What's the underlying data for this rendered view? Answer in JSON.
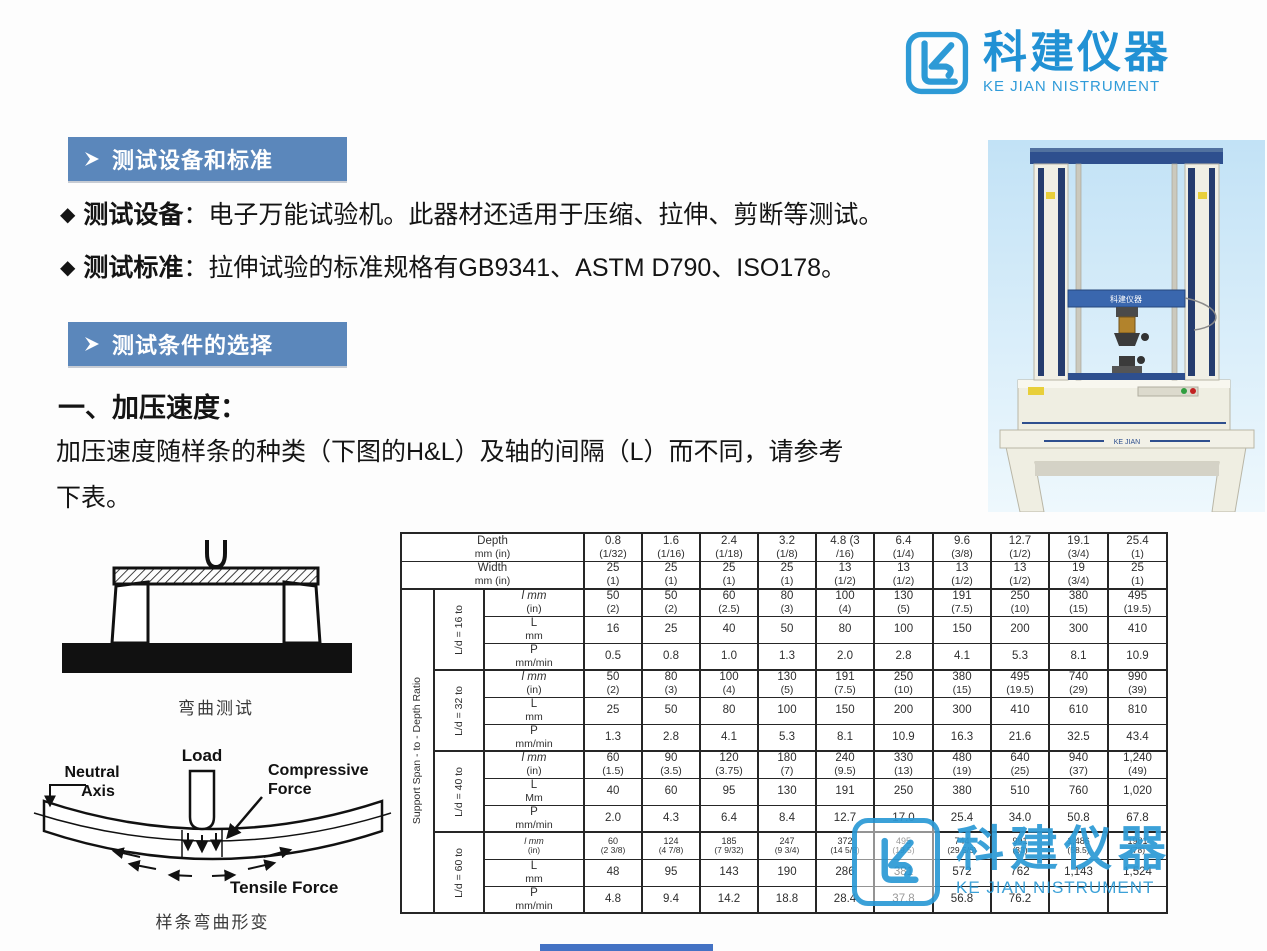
{
  "colors": {
    "banner_blue": "#5b87bb",
    "brand_blue": "#2191d4",
    "navy": "#2e4f8e"
  },
  "logo": {
    "title": "科建仪器",
    "subtitle": "KE JIAN NISTRUMENT"
  },
  "sections": {
    "banner_equipment": "测试设备和标准",
    "banner_conditions": "测试条件的选择",
    "bullet_equipment_label": "测试设备",
    "bullet_equipment_text": "：电子万能试验机。此器材还适用于压缩、拉伸、剪断等测试。",
    "bullet_standard_label": "测试标准",
    "bullet_standard_text": "：拉伸试验的标准规格有GB9341、ASTM D790、ISO178。",
    "heading_speed": "一、加压速度：",
    "para_line1": "加压速度随样条的种类（下图的H&L）及轴的间隔（L）而不同，请参考",
    "para_line2": "下表。"
  },
  "machine": {
    "stand_text": "KE JIAN",
    "crosshead_text": "科建仪器"
  },
  "diagrams": {
    "bend_caption": "弯曲测试",
    "deform_caption": "样条弯曲形变",
    "labels": {
      "load": "Load",
      "compressive1": "Compressive",
      "compressive2": "Force",
      "neutral1": "Neutral",
      "neutral2": "Axis",
      "tensile": "Tensile  Force"
    }
  },
  "table": {
    "outer_label": "Support Span - to - Depth Ratio",
    "header_rows": [
      {
        "label": "Depth",
        "unit": "mm  (in)",
        "cells": [
          [
            "0.8",
            "(1/32)"
          ],
          [
            "1.6",
            "(1/16)"
          ],
          [
            "2.4",
            "(1/18)"
          ],
          [
            "3.2",
            "(1/8)"
          ],
          [
            "4.8  (3",
            "/16)"
          ],
          [
            "6.4",
            "(1/4)"
          ],
          [
            "9.6",
            "(3/8)"
          ],
          [
            "12.7",
            "(1/2)"
          ],
          [
            "19.1",
            "(3/4)"
          ],
          [
            "25.4",
            "(1)"
          ]
        ]
      },
      {
        "label": "Width",
        "unit": "mm  (in)",
        "cells": [
          [
            "25",
            "(1)"
          ],
          [
            "25",
            "(1)"
          ],
          [
            "25",
            "(1)"
          ],
          [
            "25",
            "(1)"
          ],
          [
            "13",
            "(1/2)"
          ],
          [
            "13",
            "(1/2)"
          ],
          [
            "13",
            "(1/2)"
          ],
          [
            "13",
            "(1/2)"
          ],
          [
            "19",
            "(3/4)"
          ],
          [
            "25",
            "(1)"
          ]
        ]
      }
    ],
    "groups": [
      {
        "label": "L/d = 16 to",
        "rows": [
          {
            "main": "l  mm",
            "unit": "(in)",
            "italic": true,
            "cells": [
              [
                "50",
                "(2)"
              ],
              [
                "50",
                "(2)"
              ],
              [
                "60",
                "(2.5)"
              ],
              [
                "80",
                "(3)"
              ],
              [
                "100",
                "(4)"
              ],
              [
                "130",
                "(5)"
              ],
              [
                "191",
                "(7.5)"
              ],
              [
                "250",
                "(10)"
              ],
              [
                "380",
                "(15)"
              ],
              [
                "495",
                "(19.5)"
              ]
            ]
          },
          {
            "main": "L",
            "unit": "mm",
            "cells": [
              "16",
              "25",
              "40",
              "50",
              "80",
              "100",
              "150",
              "200",
              "300",
              "410"
            ]
          },
          {
            "main": "P",
            "unit": "mm/min",
            "cells": [
              "0.5",
              "0.8",
              "1.0",
              "1.3",
              "2.0",
              "2.8",
              "4.1",
              "5.3",
              "8.1",
              "10.9"
            ]
          }
        ]
      },
      {
        "label": "L/d = 32 to",
        "rows": [
          {
            "main": "l  mm",
            "unit": "(in)",
            "italic": true,
            "cells": [
              [
                "50",
                "(2)"
              ],
              [
                "80",
                "(3)"
              ],
              [
                "100",
                "(4)"
              ],
              [
                "130",
                "(5)"
              ],
              [
                "191",
                "(7.5)"
              ],
              [
                "250",
                "(10)"
              ],
              [
                "380",
                "(15)"
              ],
              [
                "495",
                "(19.5)"
              ],
              [
                "740",
                "(29)"
              ],
              [
                "990",
                "(39)"
              ]
            ]
          },
          {
            "main": "L",
            "unit": "mm",
            "cells": [
              "25",
              "50",
              "80",
              "100",
              "150",
              "200",
              "300",
              "410",
              "610",
              "810"
            ]
          },
          {
            "main": "P",
            "unit": "mm/min",
            "cells": [
              "1.3",
              "2.8",
              "4.1",
              "5.3",
              "8.1",
              "10.9",
              "16.3",
              "21.6",
              "32.5",
              "43.4"
            ]
          }
        ]
      },
      {
        "label": "L/d = 40 to",
        "rows": [
          {
            "main": "l  mm",
            "unit": "(in)",
            "italic": true,
            "cells": [
              [
                "60",
                "(1.5)"
              ],
              [
                "90",
                "(3.5)"
              ],
              [
                "120",
                "(3.75)"
              ],
              [
                "180",
                "(7)"
              ],
              [
                "240",
                "(9.5)"
              ],
              [
                "330",
                "(13)"
              ],
              [
                "480",
                "(19)"
              ],
              [
                "640",
                "(25)"
              ],
              [
                "940",
                "(37)"
              ],
              [
                "1,240",
                "(49)"
              ]
            ]
          },
          {
            "main": "L",
            "unit": "Mm",
            "cells": [
              "40",
              "60",
              "95",
              "130",
              "191",
              "250",
              "380",
              "510",
              "760",
              "1,020"
            ]
          },
          {
            "main": "P",
            "unit": "mm/min",
            "cells": [
              "2.0",
              "4.3",
              "6.4",
              "8.4",
              "12.7",
              "17.0",
              "25.4",
              "34.0",
              "50.8",
              "67.8"
            ]
          }
        ]
      },
      {
        "label": "L/d = 60 to",
        "rows": [
          {
            "main": "l  mm",
            "unit": "(in)",
            "italic": true,
            "small": true,
            "cells": [
              [
                "60",
                "(2  3/8)"
              ],
              [
                "124",
                "(4  7/8)"
              ],
              [
                "185",
                "(7  9/32)"
              ],
              [
                "247",
                "(9  3/4)"
              ],
              [
                "372",
                "(14  5/8)"
              ],
              [
                "495",
                "(19.5)"
              ],
              [
                "744",
                "(29  5/6)"
              ],
              [
                "991",
                "(33)"
              ],
              [
                "1,486",
                "(58.5)"
              ],
              [
                "1981",
                "(78)"
              ]
            ]
          },
          {
            "main": "L",
            "unit": "mm",
            "cells": [
              "48",
              "95",
              "143",
              "190",
              "286",
              "381",
              "572",
              "762",
              "1,143",
              "1,524"
            ]
          },
          {
            "main": "P",
            "unit": "mm/min",
            "cells": [
              "4.8",
              "9.4",
              "14.2",
              "18.8",
              "28.4",
              "37.8",
              "56.8",
              "76.2",
              "",
              ""
            ]
          }
        ]
      }
    ]
  }
}
